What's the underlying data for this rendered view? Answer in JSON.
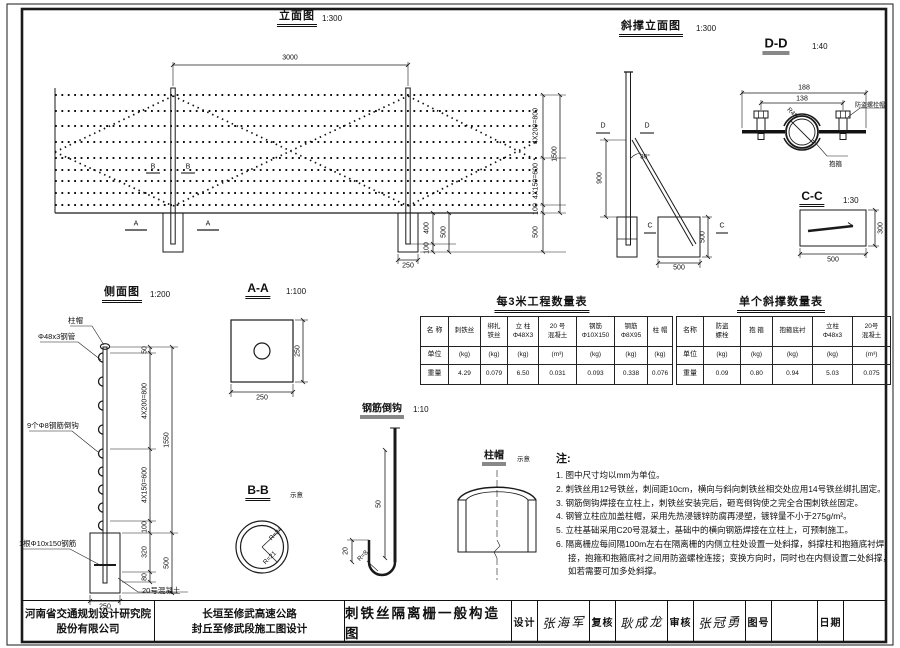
{
  "views": {
    "elevation": {
      "title": "立面图",
      "scale": "1:300",
      "dim_span": "3000",
      "dim_total": "1500",
      "dim_top": "4X200=800",
      "dim_bottom": "4X150=600",
      "dim_ground": "100",
      "dim_found_depth": "500",
      "found_embed": "400",
      "found_depth": "500",
      "found_under": "100",
      "found_width": "250",
      "marker_a": "A",
      "marker_b": "B"
    },
    "brace": {
      "title": "斜撑立面图",
      "scale": "1:300",
      "dim_height": "900",
      "angle": "30°",
      "found_width": "500",
      "found_depth": "500",
      "marker_c": "C",
      "marker_d": "D"
    },
    "dd": {
      "title": "D-D",
      "scale": "1:40",
      "dim_outer": "188",
      "dim_inner": "138",
      "dim_radius": "R48",
      "label_bolt": "防盗螺栓帽",
      "label_clamp": "抱箍"
    },
    "cc": {
      "title": "C-C",
      "scale": "1:30",
      "dim_width": "500",
      "dim_height": "300"
    },
    "side": {
      "title": "侧面图",
      "scale": "1:200",
      "label_cap": "柱帽",
      "label_pipe": "Φ48x3钢管",
      "label_hooks": "9个Φ8钢筋倒钩",
      "label_rebar": "1根Φ10x150钢筋",
      "label_concrete": "20号混凝土",
      "dim_50": "50",
      "dim_top": "4X200=800",
      "dim_bottom": "4X150=600",
      "dim_100": "100",
      "dim_320": "320",
      "dim_80": "80",
      "dim_total": "1550",
      "dim_found": "500",
      "dim_width": "250"
    },
    "aa": {
      "title": "A-A",
      "scale": "1:100",
      "dim_w": "250",
      "dim_h": "250"
    },
    "bb": {
      "title": "B-B",
      "note": "示意",
      "r_outer": "R=24",
      "r_inner": "R=21"
    },
    "hook": {
      "title": "钢筋倒钩",
      "scale": "1:10",
      "dim_len": "50",
      "dim_return": "20",
      "dim_r": "R=8"
    },
    "cap": {
      "title": "柱帽",
      "note": "示意"
    }
  },
  "tables": {
    "per3m": {
      "title": "每3米工程数量表",
      "label_name": "名 称",
      "label_unit": "单位",
      "label_qty": "重量",
      "cols": [
        {
          "n1": "刺铁丝",
          "n2": "",
          "unit": "(kg)",
          "qty": "4.29"
        },
        {
          "n1": "绑扎",
          "n2": "铁丝",
          "unit": "(kg)",
          "qty": "0.079"
        },
        {
          "n1": "立 柱",
          "n2": "Φ48X3",
          "unit": "(kg)",
          "qty": "6.50"
        },
        {
          "n1": "20 号",
          "n2": "混凝土",
          "unit": "(m³)",
          "qty": "0.031"
        },
        {
          "n1": "钢筋",
          "n2": "Φ10X150",
          "unit": "(kg)",
          "qty": "0.093"
        },
        {
          "n1": "钢筋",
          "n2": "Φ8X95",
          "unit": "(kg)",
          "qty": "0.338"
        },
        {
          "n1": "柱 帽",
          "n2": "",
          "unit": "(kg)",
          "qty": "0.076"
        }
      ]
    },
    "brace": {
      "title": "单个斜撑数量表",
      "label_name": "名称",
      "label_unit": "单位",
      "label_qty": "重量",
      "cols": [
        {
          "n1": "防盗",
          "n2": "螺栓",
          "unit": "(kg)",
          "qty": "0.09"
        },
        {
          "n1": "抱 箍",
          "n2": "",
          "unit": "(kg)",
          "qty": "0.80"
        },
        {
          "n1": "抱箍底衬",
          "n2": "",
          "unit": "(kg)",
          "qty": "0.94"
        },
        {
          "n1": "立柱",
          "n2": "Φ48x3",
          "unit": "(kg)",
          "qty": "5.03"
        },
        {
          "n1": "20号",
          "n2": "混凝土",
          "unit": "(m³)",
          "qty": "0.075"
        }
      ]
    }
  },
  "notes": {
    "heading": "注:",
    "items": [
      "1. 图中尺寸均以mm为单位。",
      "2. 刺铁丝用12号铁丝，刺间距10cm，横向与斜向刺铁丝相交处应用14号铁丝绑扎固定。",
      "3. 钢筋倒钩焊接在立柱上，刺铁丝安装完后，砸弯倒钩使之完全合围刺铁丝固定。",
      "4. 钢管立柱应加盖柱帽，采用先热浸镀锌防腐再浸塑，镀锌量不小于275g/m²。",
      "5. 立柱基础采用C20号混凝土，基础中的横向钢筋焊接在立柱上，可预制施工。",
      "6. 隔离栅应每间隔100m左右在隔离栅的内侧立柱处设置一处斜撑，斜撑柱和抱箍底衬焊接，抱箍和抱箍底衬之间用防盗螺栓连接；变换方向时，同时也在内侧设置二处斜撑，如若需要可加多处斜撑。"
    ]
  },
  "titleblock": {
    "company_line1": "河南省交通规划设计研究院",
    "company_line2": "股份有限公司",
    "project_line1": "长垣至修武高速公路",
    "project_line2": "封丘至修武段施工图设计",
    "drawing_title": "刺铁丝隔离栅一般构造图",
    "design_label": "设计",
    "design_sig": "张海军",
    "check_label": "复核",
    "check_sig": "耿成龙",
    "review_label": "审核",
    "review_sig": "张冠勇",
    "number_label": "图号",
    "number_value": "",
    "date_label": "日期",
    "date_value": ""
  }
}
